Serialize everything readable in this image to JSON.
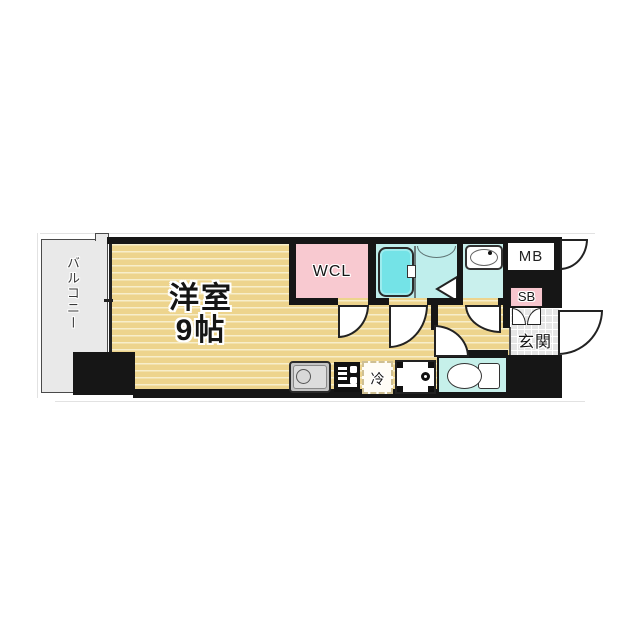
{
  "rooms": {
    "balcony": {
      "label": "バルコニー"
    },
    "main": {
      "name": "洋室",
      "size": "9帖"
    },
    "wcl": {
      "label": "WCL"
    },
    "genkan": {
      "label": "玄関"
    },
    "mb": {
      "label": "MB"
    },
    "sb": {
      "label": "SB"
    },
    "fridge": {
      "label": "冷"
    }
  },
  "fixtures": {
    "list": [
      "bathtub",
      "shower-room",
      "washbasin",
      "toilet",
      "kitchen-sink",
      "gas-stove",
      "washer-pan",
      "refrigerator-space",
      "window",
      "door-swing",
      "double-door",
      "folding-door"
    ]
  },
  "colors": {
    "wall": "#161616",
    "flooring": "#edd48d",
    "flooring_stripe": "#f7eecb",
    "wcl_pink": "#f8c9d0",
    "sb_pink": "#f7c6ce",
    "bath_floor": "#bfeeec",
    "bathtub": "#74e3e7",
    "washbasin_floor": "#c9f0ed",
    "toilet_floor": "#c6f0ea",
    "balcony_gray": "#e9e9e9",
    "genkan_tile": "#e6e6e6"
  }
}
